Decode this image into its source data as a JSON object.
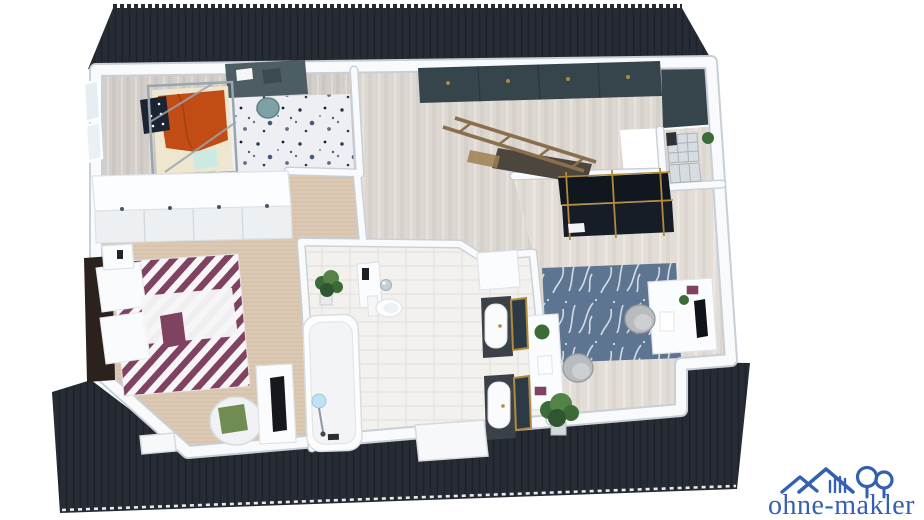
{
  "watermark": {
    "text": "ohne-makler",
    "brand_color": "#3560b2"
  },
  "scene": {
    "kind": "3d-floor-plan-render",
    "view": "isometric-top-down",
    "rooms": [
      "kids-room",
      "hallway-landing",
      "storage-nook",
      "office-dressing-room",
      "bathroom",
      "master-bedroom"
    ],
    "furniture": [
      "canopy-bed",
      "kids-desk",
      "desk-chair",
      "speckled-rug",
      "wardrobe-row",
      "double-bed",
      "nightstand",
      "armchair",
      "tv-console",
      "potted-plants",
      "built-in-cabinets",
      "staircase-railing",
      "wire-baskets",
      "clothes-rack",
      "office-desks",
      "office-chairs",
      "branch-pattern-rug",
      "bathtub",
      "shower-stand",
      "toilet",
      "washbasin-cabinet",
      "water-heater",
      "tall-cabinet",
      "double-vanity-mirrors"
    ]
  },
  "palette": {
    "roof": "#272c34",
    "roof_rib": "#1d222a",
    "wall": "#f8fafc",
    "wall_shadow": "#c9cfd6",
    "wood_hall": "#dcd7d1",
    "wood_kids": "#d3cec9",
    "wood_office": "#e2ddd7",
    "tile": "#f2f1ee",
    "carpet": "#dcc9b3",
    "rug_kids": "#edeff2",
    "rug_office": "#5d7590",
    "cabinet_dark": "#36444c",
    "desk_slate": "#4c5e63",
    "accent_orange": "#c14d15",
    "teal_chair": "#7fa0a6",
    "stripe_purple": "#7f4260",
    "gold": "#b08a3e",
    "wood_rail": "#8a6f4d",
    "plant_green": "#3c6b38",
    "chrome": "#c3d0da",
    "headboard": "#2b211d",
    "rack_black": "#11171f",
    "logo_blue": "#3560b2"
  }
}
